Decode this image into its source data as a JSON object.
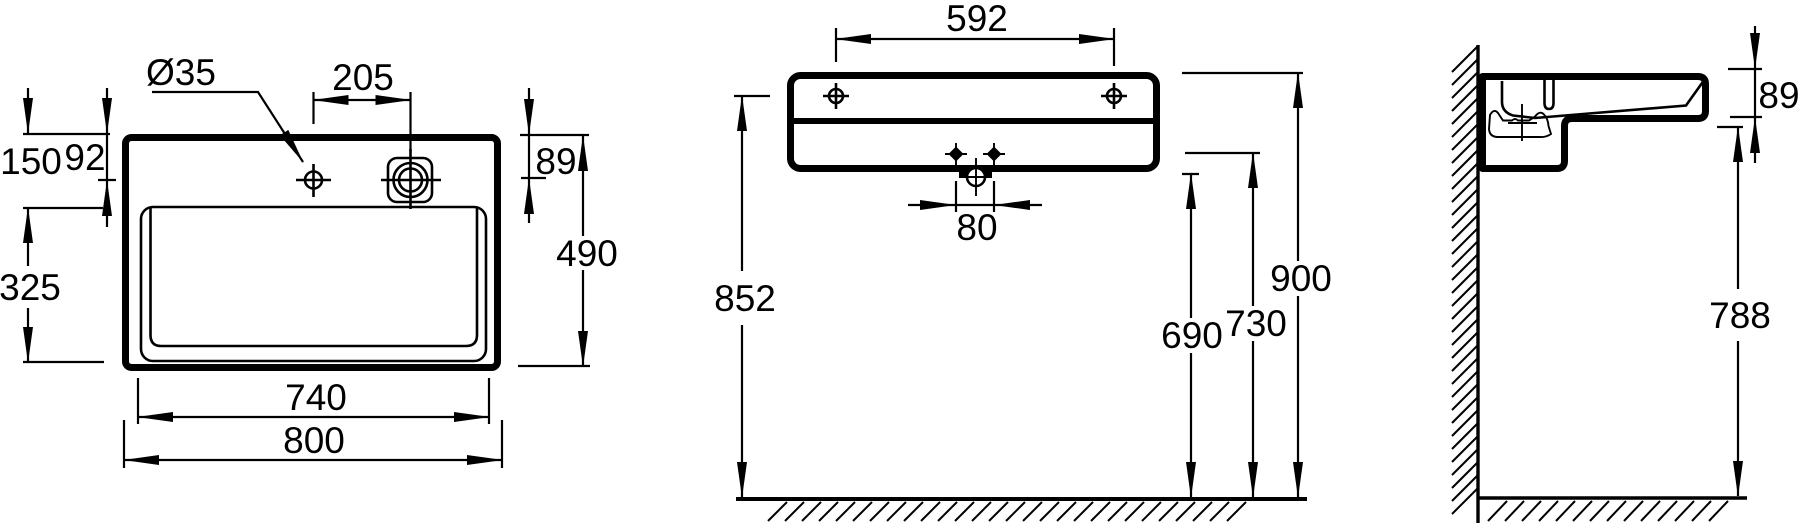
{
  "page": {
    "background": "#ffffff",
    "line_color": "#000000"
  },
  "drawing": {
    "type": "technical-dimension-drawing",
    "subject": "wall-hung rectangular washbasin, three orthographic views with installation dimensions (mm)",
    "views": {
      "plan": {
        "name": "plan-view",
        "dims": {
          "faucet_hole_dia": "Ø35",
          "hole_spacing": "205",
          "front_to_bowl": "150",
          "front_to_faucet": "92",
          "front_to_overflow": "89",
          "overall_depth": "490",
          "bowl_depth": "325",
          "bowl_width": "740",
          "overall_width": "800"
        }
      },
      "front": {
        "name": "front-elevation",
        "dims": {
          "fixing_hole_spacing": "592",
          "drain_offset": "80",
          "floor_to_fixing_holes": "852",
          "floor_to_siphon_low": "690",
          "floor_to_siphon_high": "730",
          "floor_to_rim": "900"
        }
      },
      "side": {
        "name": "side-section",
        "dims": {
          "apron_height": "89",
          "floor_to_underside": "788"
        }
      }
    }
  }
}
